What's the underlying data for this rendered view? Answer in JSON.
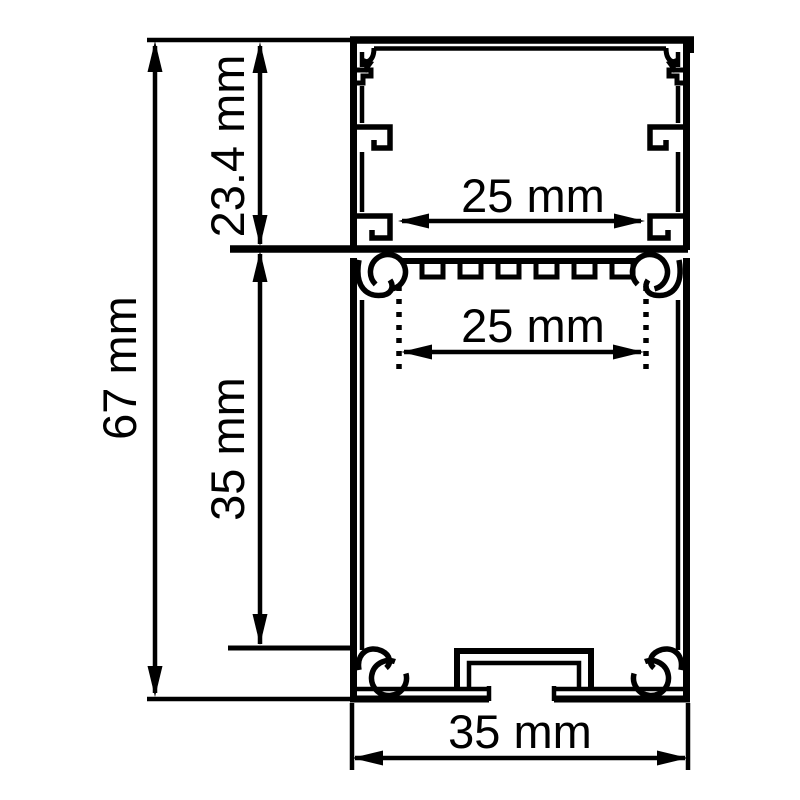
{
  "background_color": "#ffffff",
  "line_color": "#000000",
  "drawing": {
    "type": "technical-cross-section",
    "dimensions": [
      {
        "id": "overall-height",
        "label": "67 mm",
        "value": 67,
        "unit": "mm",
        "orientation": "vertical"
      },
      {
        "id": "upper-section-height",
        "label": "23.4 mm",
        "value": 23.4,
        "unit": "mm",
        "orientation": "vertical"
      },
      {
        "id": "lower-section-height",
        "label": "35 mm",
        "value": 35,
        "unit": "mm",
        "orientation": "vertical"
      },
      {
        "id": "upper-cavity-width",
        "label": "25 mm",
        "value": 25,
        "unit": "mm",
        "orientation": "horizontal"
      },
      {
        "id": "strip-cavity-width",
        "label": "25 mm",
        "value": 25,
        "unit": "mm",
        "orientation": "horizontal"
      },
      {
        "id": "overall-width",
        "label": "35 mm",
        "value": 35,
        "unit": "mm",
        "orientation": "horizontal"
      }
    ]
  }
}
